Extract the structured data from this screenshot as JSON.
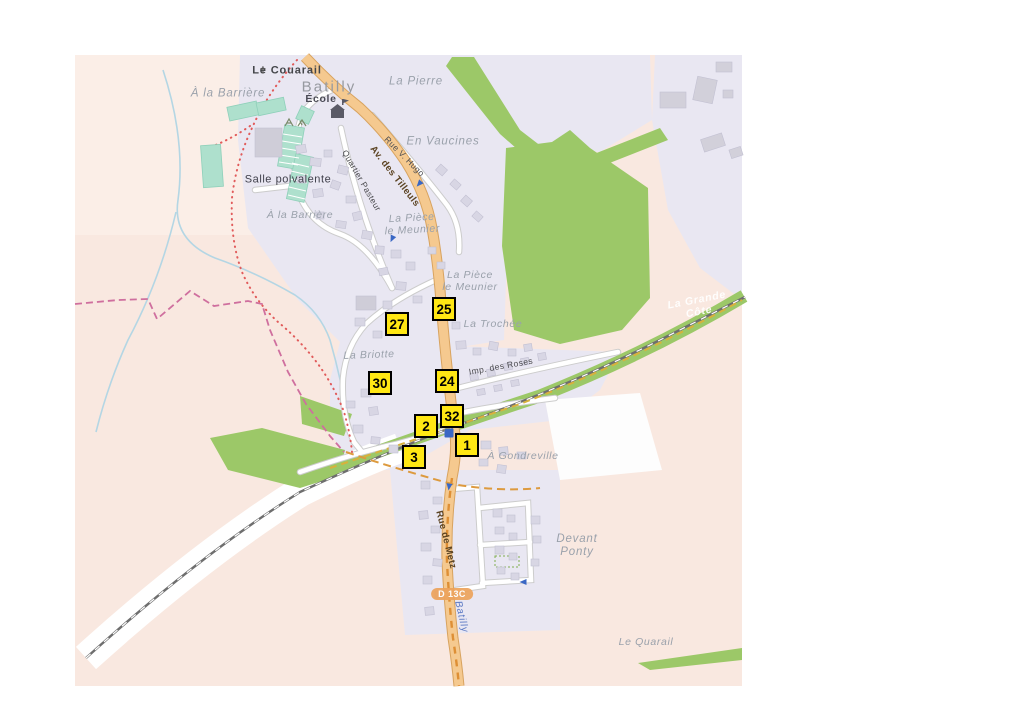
{
  "map": {
    "colors": {
      "marker_yellow": "#ffe714",
      "marker_border": "#000000",
      "road_orange": "#f5c98f",
      "road_orange_casing": "#d8a35f",
      "forest_green": "#9cc868",
      "builtup_lavender": "#e9e7f2",
      "farmland_pink": "#f9e8e0",
      "pitch_teal": "#aee0cd",
      "building_gray": "#d8d6e4",
      "railway_gray": "#6e6e6e",
      "boundary_pink": "#cf6f9e",
      "path_red": "#e15b5b",
      "path_orange": "#dd9a3e",
      "water_blue": "#b4d6e4",
      "parking_blue": "#3a67c4",
      "shield_orange": "#eda35c"
    },
    "markers": [
      {
        "number": "27",
        "x": 397,
        "y": 324
      },
      {
        "number": "25",
        "x": 444,
        "y": 309
      },
      {
        "number": "24",
        "x": 447,
        "y": 381
      },
      {
        "number": "30",
        "x": 380,
        "y": 383
      },
      {
        "number": "2",
        "x": 426,
        "y": 426
      },
      {
        "number": "32",
        "x": 452,
        "y": 416
      },
      {
        "number": "1",
        "x": 467,
        "y": 445
      },
      {
        "number": "3",
        "x": 414,
        "y": 457
      }
    ],
    "place_labels": [
      {
        "name": "label-a-la-barriere-nord",
        "text": "À la Barrière",
        "x": 228,
        "y": 94,
        "rot": 0,
        "cls": "locality"
      },
      {
        "name": "label-la-pierre",
        "text": "La Pierre",
        "x": 416,
        "y": 82,
        "rot": 0,
        "cls": "locality"
      },
      {
        "name": "label-en-vaucines",
        "text": "En Vaucines",
        "x": 443,
        "y": 142,
        "rot": 0,
        "cls": "locality"
      },
      {
        "name": "label-a-la-barriere-sud",
        "text": "À la Barrière",
        "x": 300,
        "y": 215,
        "rot": 0,
        "cls": "locality-sm"
      },
      {
        "name": "label-la-piece-le-meunier-1",
        "text": "La Pièce\nle Meunier",
        "x": 412,
        "y": 224,
        "rot": -3,
        "cls": "locality-sm"
      },
      {
        "name": "label-la-piece-le-meunier-2",
        "text": "La Pièce\nle Meunier",
        "x": 470,
        "y": 281,
        "rot": 0,
        "cls": "locality-sm"
      },
      {
        "name": "label-la-trochee",
        "text": "La Trochée",
        "x": 493,
        "y": 324,
        "rot": 0,
        "cls": "locality-sm"
      },
      {
        "name": "label-la-briotte",
        "text": "La Briotte",
        "x": 369,
        "y": 355,
        "rot": -2,
        "cls": "locality-sm"
      },
      {
        "name": "label-a-gondreville",
        "text": "À Gondreville",
        "x": 523,
        "y": 456,
        "rot": 0,
        "cls": "locality-sm"
      },
      {
        "name": "label-devant-ponty",
        "text": "Devant\nPonty",
        "x": 577,
        "y": 546,
        "rot": 0,
        "cls": "locality"
      },
      {
        "name": "label-le-quarail",
        "text": "Le Quarail",
        "x": 646,
        "y": 642,
        "rot": 0,
        "cls": "locality-sm"
      },
      {
        "name": "label-la-grande-cote",
        "text": "La Grande\nCôte",
        "x": 698,
        "y": 306,
        "rot": -11,
        "cls": "forest-label"
      },
      {
        "name": "label-batilly-boundary",
        "text": "Batilly",
        "x": 461,
        "y": 617,
        "rot": 77,
        "cls": "boundary-blue"
      },
      {
        "name": "label-le-couarail",
        "text": "Le Couarail",
        "x": 287,
        "y": 71,
        "rot": 0,
        "cls": "hamlet"
      },
      {
        "name": "label-batilly-town",
        "text": "Batilly",
        "x": 329,
        "y": 87,
        "rot": 0,
        "cls": "place-town"
      },
      {
        "name": "label-ecole",
        "text": "École",
        "x": 321,
        "y": 99,
        "rot": 0,
        "cls": "amenity"
      },
      {
        "name": "label-salle-polvalente",
        "text": "Salle polvalente",
        "x": 288,
        "y": 180,
        "rot": 0,
        "cls": "amenity2"
      }
    ],
    "street_labels": [
      {
        "name": "street-av-des-tilleuls",
        "text": "Av. des Tilleuls",
        "x": 394,
        "y": 177,
        "rot": 52,
        "cls": "street-orange"
      },
      {
        "name": "street-rue-v-hugo",
        "text": "Rue V. Hugo",
        "x": 404,
        "y": 157,
        "rot": 45,
        "cls": "street"
      },
      {
        "name": "street-quartier-pasteur",
        "text": "Quartier Pasteur",
        "x": 361,
        "y": 181,
        "rot": 60,
        "cls": "street"
      },
      {
        "name": "street-imp-des-roses",
        "text": "Imp. des Roses",
        "x": 501,
        "y": 367,
        "rot": -10,
        "cls": "street"
      },
      {
        "name": "street-rue-de-metz",
        "text": "Rue de Metz",
        "x": 445,
        "y": 540,
        "rot": 76,
        "cls": "street-orange"
      }
    ],
    "shield": {
      "text": "D 13C",
      "x": 452,
      "y": 594
    },
    "icons": {
      "cross_glyph": "✝",
      "cross_pos": {
        "x": 263,
        "y": 71
      },
      "parking_pos": {
        "x": 449,
        "y": 433
      },
      "oneway_arrows": [
        {
          "x": 419,
          "y": 184,
          "rot": 42
        },
        {
          "x": 392,
          "y": 239,
          "rot": 25
        },
        {
          "x": 449,
          "y": 487,
          "rot": 8
        },
        {
          "x": 523,
          "y": 582,
          "rot": 90
        }
      ]
    }
  }
}
